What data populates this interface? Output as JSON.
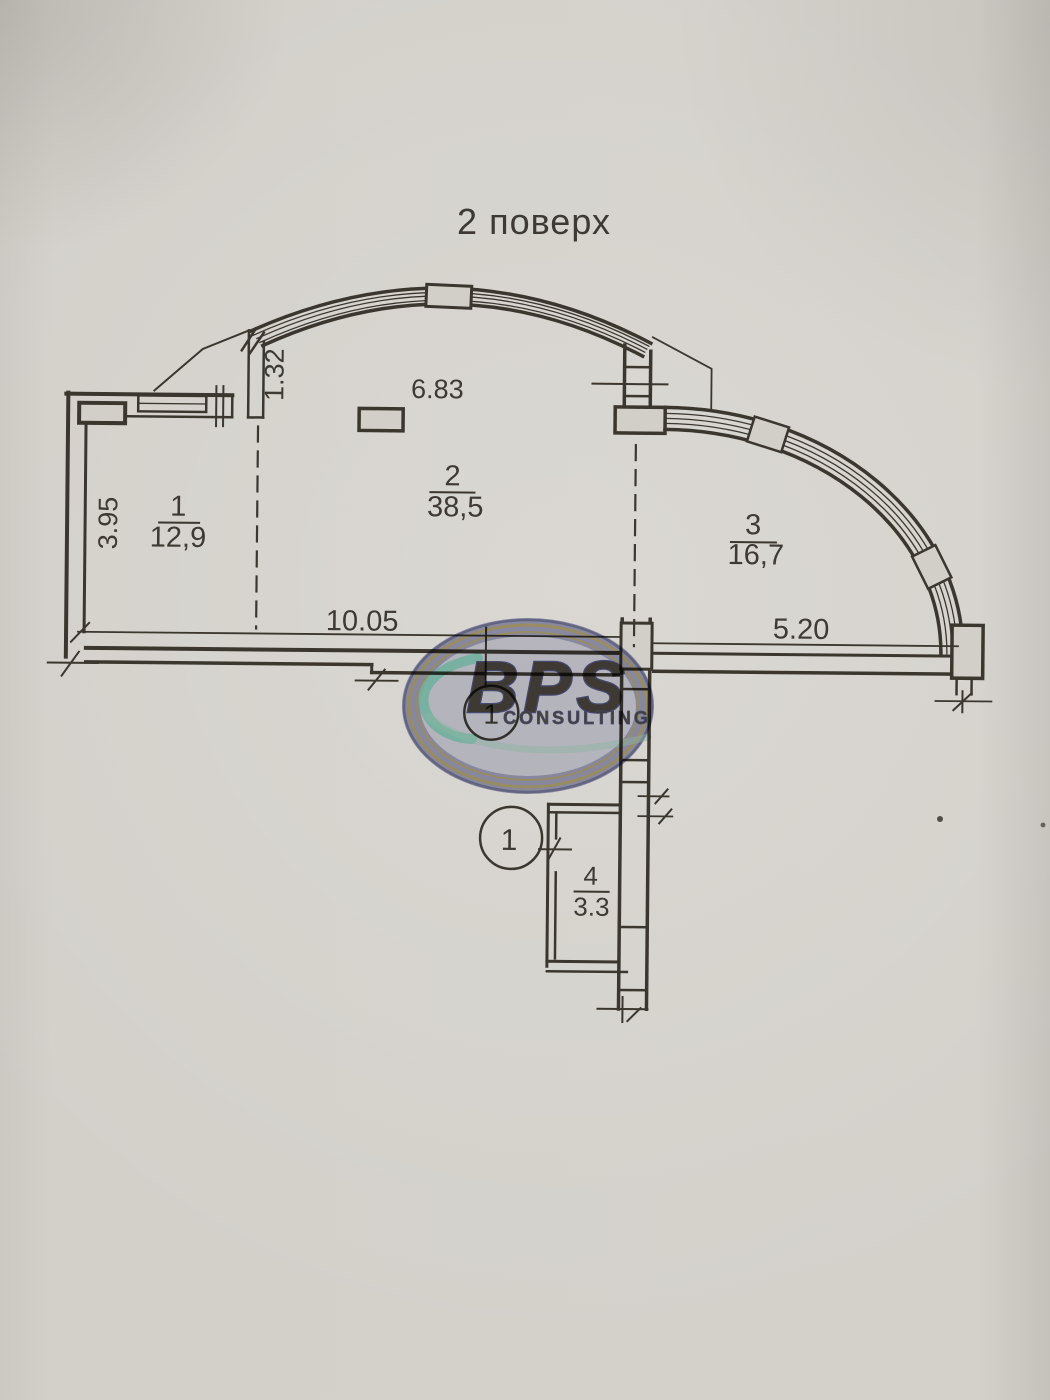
{
  "title": "2 поверх",
  "rooms": [
    {
      "number": "1",
      "area": "12,9"
    },
    {
      "number": "2",
      "area": "38,5"
    },
    {
      "number": "3",
      "area": "16,7"
    },
    {
      "number": "4",
      "area": "3.3"
    }
  ],
  "dimensions": {
    "left_height": "3.95",
    "arc_offset": "1.32",
    "top_width": "6.83",
    "bottom_left": "10.05",
    "bottom_right": "5.20"
  },
  "markers": [
    {
      "label": "1"
    },
    {
      "label": "1"
    }
  ],
  "watermark": {
    "brand": "BPS",
    "subtitle": "CONSULTING",
    "navy": "#6a6fa6",
    "gold": "#c9b87c",
    "teal": "#7fd0bf"
  },
  "colors": {
    "paper": "#d1cec8",
    "ink": "#3b372f"
  }
}
